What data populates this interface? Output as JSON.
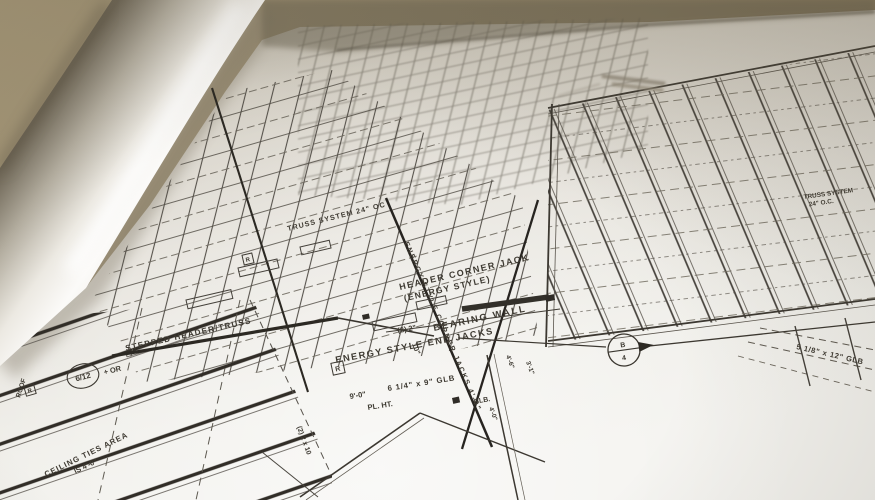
{
  "scene": {
    "subject": "photograph of an architectural framing blueprint lying on a drafting table with the left page curled",
    "colors": {
      "table": "#94876c",
      "paper_bright": "#f3f2ee",
      "paper_shadow": "#b7b1a3",
      "ink": "#3f3b34",
      "ink_bold": "#2c2923"
    }
  },
  "labels": {
    "stepped_header": "STEPPED HEADER/TRUSS",
    "header_corner_jack_line1": "HEADER CORNER JACK",
    "header_corner_jack_line2": "(ENERGY STYLE)",
    "bearing_wall": "BEARING WALL",
    "end_jacks": "ENERGY STYLE END JACKS",
    "corner_jacks_diagonal": "ENERGY STYLE CORNER JACKS 4'-0\"",
    "glb_6x9": "6 1/4\" x 9\" GLB",
    "plate_height_value": "9'-0\"",
    "plate_height": "PL. HT.",
    "glb_bottom": "GLB.",
    "two_2x": "(2) 2\"",
    "ten": "10\"",
    "two_2x10": "(2) 2 x 10",
    "truss_center_note": "TRUSS SYSTEM 24\" OC",
    "truss_right_line1": "TRUSS SYSTEM",
    "truss_right_line2": "24\" O.C.",
    "glb_5x12": "5 1/8\" x 12\" GLB",
    "roof": "ROOF",
    "ceiling_line1": "CEILING TIES AREA",
    "ceiling_line2": "IS 4'-0\"",
    "dim_a": "4'-6\"",
    "dim_b": "3'-1\"",
    "dim_c": "4'-0\""
  },
  "markers": {
    "roof_pitch": {
      "value": "6/12",
      "suffix": "+ OR"
    },
    "section_cut": {
      "top": "B",
      "bottom": "4"
    },
    "r_symbol": "R"
  }
}
